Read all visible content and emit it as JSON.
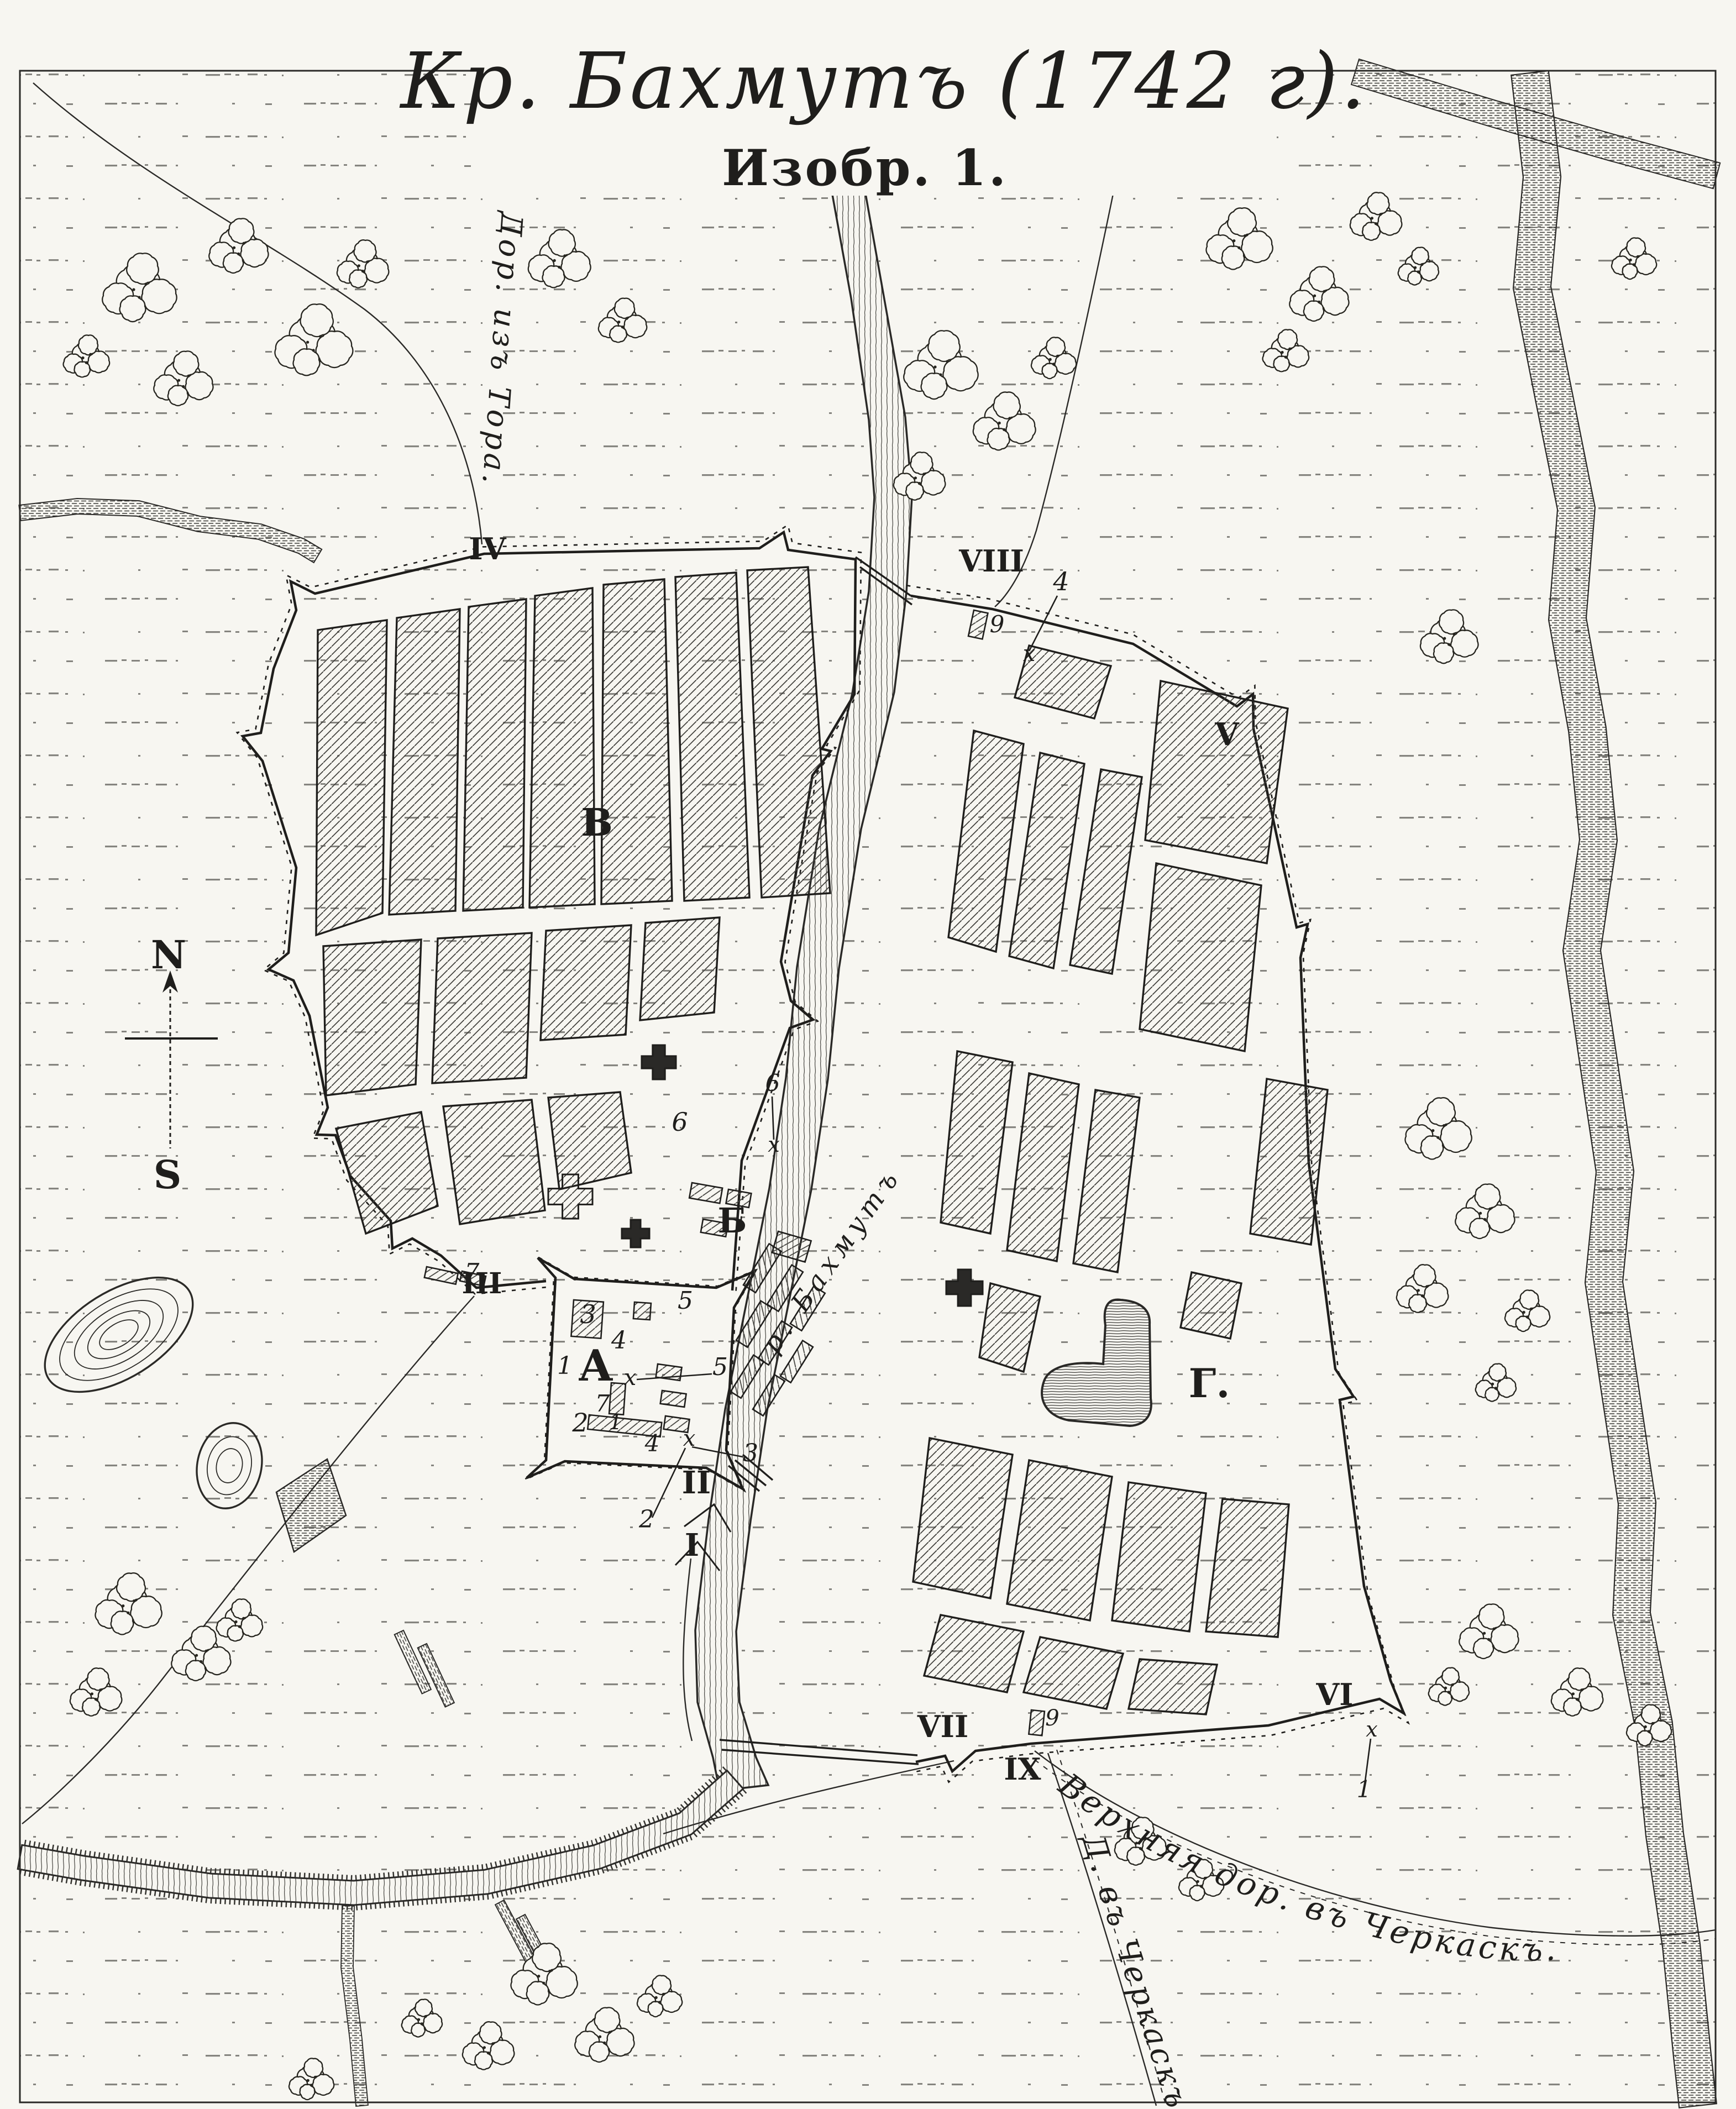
{
  "title": {
    "main": "Кр. Бахмутъ (1742 г).",
    "figure": "Изобр. 1."
  },
  "compass": {
    "north": "N",
    "south": "S"
  },
  "roads": {
    "tor": "Дор. изъ Тора.",
    "upper_cherkassk": "Верхняя дор. въ Черкаскъ.",
    "lower_cherkassk": "Д. въ Черкаскъ."
  },
  "river": {
    "name": "р. Бахмутъ"
  },
  "areas": {
    "citadel": "А",
    "suburb": "Б",
    "west_town": "В",
    "east_town": "Г."
  },
  "bastions": {
    "i": "I",
    "ii": "II",
    "iii": "III",
    "iv": "IV",
    "v": "V",
    "vi": "VI",
    "vii": "VII",
    "viii": "VIII",
    "ix": "IX"
  },
  "marks": {
    "n1_citadel": "1",
    "n2_citadel": "2",
    "n3_citadel": "3",
    "n4_citadel": "4",
    "n7_citadel": "7",
    "n1b_citadel": "1",
    "n4b_citadel": "4",
    "n5a_suburb": "5",
    "n5b_suburb": "5",
    "x_citadel": "х",
    "x_south": "х",
    "n3_south": "3",
    "n2_south": "2",
    "n6a_center": "6",
    "n6b_center": "6",
    "x_center": "х",
    "n7_west": "7",
    "n4_north": "4",
    "n9_north": "9",
    "x_north": "х",
    "n9_south": "9",
    "x_southeast": "х",
    "n1_southeast": "1"
  },
  "colors": {
    "ink": "#1f1e1c",
    "paper": "#f7f6f1"
  }
}
